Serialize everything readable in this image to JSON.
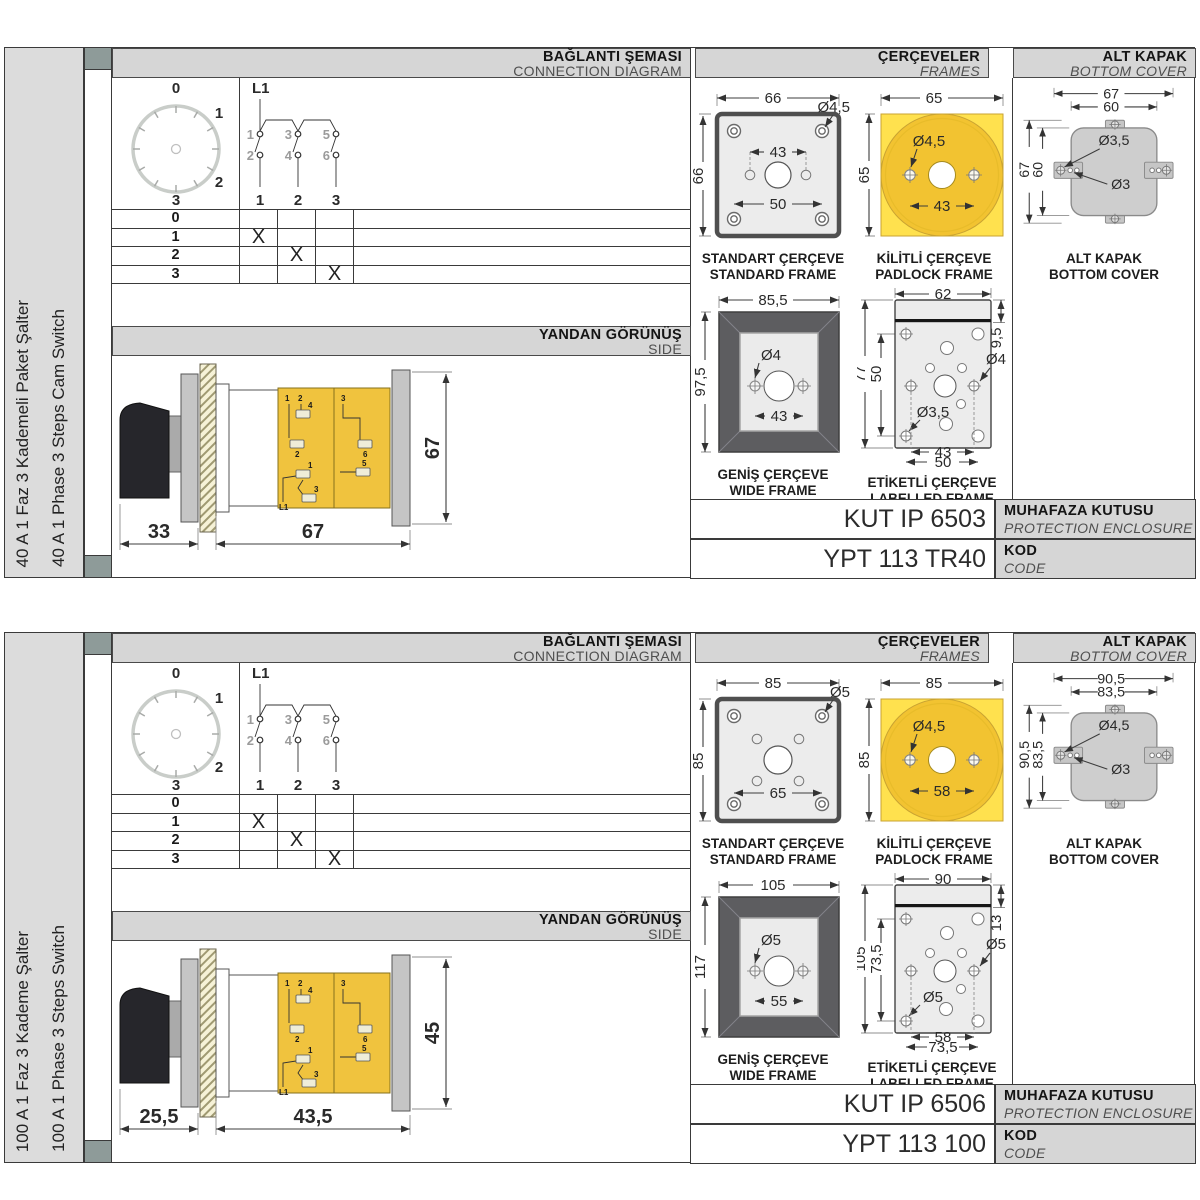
{
  "sections": [
    {
      "sidebar": {
        "title_tr": "40 A 1 Faz 3 Kademeli Paket Şalter",
        "title_en": "40 A 1 Phase 3 Steps Cam Switch"
      },
      "connection": {
        "header_tr": "BAĞLANTI ŞEMASI",
        "header_en": "CONNECTION DIAGRAM",
        "dial": {
          "p0": "0",
          "p1": "1",
          "p2": "2",
          "p3": "3"
        },
        "diagram": {
          "input": "L1",
          "t1": "1",
          "t2": "2",
          "t3": "3",
          "t4": "4",
          "t5": "5",
          "t6": "6",
          "o1": "1",
          "o2": "2",
          "o3": "3"
        },
        "table": {
          "rows": [
            {
              "label": "0",
              "c1": "",
              "c2": "",
              "c3": ""
            },
            {
              "label": "1",
              "c1": "X",
              "c2": "",
              "c3": ""
            },
            {
              "label": "2",
              "c1": "",
              "c2": "X",
              "c3": ""
            },
            {
              "label": "3",
              "c1": "",
              "c2": "",
              "c3": "X"
            }
          ]
        }
      },
      "side": {
        "header_tr": "YANDAN GÖRÜNÜŞ",
        "header_en": "SIDE",
        "dim_handle": "33",
        "dim_body": "67",
        "dim_height": "67",
        "t0": "1",
        "t1": "2",
        "t2": "4",
        "t3": "2",
        "t4": "3",
        "t5": "6",
        "t6": "1",
        "t7": "3",
        "t8": "5",
        "t9": "L1"
      },
      "frames": {
        "header_tr": "ÇERÇEVELER",
        "header_en": "FRAMES",
        "standard": {
          "dim_width": "66",
          "dim_height": "66",
          "dim_hole": "Ø4,5",
          "dim_inner": "43",
          "dim_outer": "50",
          "label_tr": "STANDART ÇERÇEVE",
          "label_en": "STANDARD FRAME"
        },
        "padlock": {
          "dim_width": "65",
          "dim_height": "65",
          "dim_hole": "Ø4,5",
          "dim_inner": "43",
          "label_tr": "KİLİTLİ ÇERÇEVE",
          "label_en": "PADLOCK FRAME"
        },
        "wide": {
          "dim_width": "85,5",
          "dim_height": "97,5",
          "dim_hole": "Ø4",
          "dim_inner": "43",
          "label_tr": "GENİŞ ÇERÇEVE",
          "label_en": "WIDE FRAME"
        },
        "labelled": {
          "dim_width": "62",
          "dim_strip": "9,5",
          "dim_height": "77",
          "dim_inner_h": "50",
          "dim_hole": "Ø4",
          "dim_hole_small": "Ø3,5",
          "dim_inner": "43",
          "dim_outer": "50",
          "label_tr": "ETİKETLİ ÇERÇEVE",
          "label_en": "LABELLED FRAME"
        }
      },
      "cover": {
        "header_tr": "ALT KAPAK",
        "header_en": "BOTTOM COVER",
        "dim_w1": "67",
        "dim_w2": "60",
        "dim_h1": "67",
        "dim_h2": "60",
        "dim_hole1": "Ø3,5",
        "dim_hole2": "Ø3",
        "label_tr": "ALT KAPAK",
        "label_en": "BOTTOM COVER"
      },
      "codes": {
        "enclosure_value": "KUT IP 6503",
        "enclosure_tr": "MUHAFAZA KUTUSU",
        "enclosure_en": "PROTECTION ENCLOSURE",
        "code_value": "YPT 113 TR40",
        "code_tr": "KOD",
        "code_en": "CODE"
      }
    },
    {
      "sidebar": {
        "title_tr": "100 A 1 Faz 3 Kademe Şalter",
        "title_en": "100 A 1 Phase 3 Steps Switch"
      },
      "connection": {
        "header_tr": "BAĞLANTI ŞEMASI",
        "header_en": "CONNECTION DIAGRAM",
        "dial": {
          "p0": "0",
          "p1": "1",
          "p2": "2",
          "p3": "3"
        },
        "diagram": {
          "input": "L1",
          "t1": "1",
          "t2": "2",
          "t3": "3",
          "t4": "4",
          "t5": "5",
          "t6": "6",
          "o1": "1",
          "o2": "2",
          "o3": "3"
        },
        "table": {
          "rows": [
            {
              "label": "0",
              "c1": "",
              "c2": "",
              "c3": ""
            },
            {
              "label": "1",
              "c1": "X",
              "c2": "",
              "c3": ""
            },
            {
              "label": "2",
              "c1": "",
              "c2": "X",
              "c3": ""
            },
            {
              "label": "3",
              "c1": "",
              "c2": "",
              "c3": "X"
            }
          ]
        }
      },
      "side": {
        "header_tr": "YANDAN GÖRÜNÜŞ",
        "header_en": "SIDE",
        "dim_handle": "25,5",
        "dim_body": "43,5",
        "dim_height": "45",
        "t0": "1",
        "t1": "2",
        "t2": "4",
        "t3": "2",
        "t4": "3",
        "t5": "6",
        "t6": "1",
        "t7": "3",
        "t8": "5",
        "t9": "L1"
      },
      "frames": {
        "header_tr": "ÇERÇEVELER",
        "header_en": "FRAMES",
        "standard": {
          "dim_width": "85",
          "dim_height": "85",
          "dim_hole": "Ø5",
          "dim_inner": "65",
          "label_tr": "STANDART ÇERÇEVE",
          "label_en": "STANDARD FRAME"
        },
        "padlock": {
          "dim_width": "85",
          "dim_height": "85",
          "dim_hole": "Ø4,5",
          "dim_inner": "58",
          "label_tr": "KİLİTLİ ÇERÇEVE",
          "label_en": "PADLOCK FRAME"
        },
        "wide": {
          "dim_width": "105",
          "dim_height": "117",
          "dim_hole": "Ø5",
          "dim_inner": "55",
          "label_tr": "GENİŞ ÇERÇEVE",
          "label_en": "WIDE FRAME"
        },
        "labelled": {
          "dim_width": "90",
          "dim_strip": "13",
          "dim_height": "105",
          "dim_inner_h": "73,5",
          "dim_hole": "Ø5",
          "dim_hole_small": "Ø5",
          "dim_inner": "58",
          "dim_outer": "73,5",
          "label_tr": "ETİKETLİ ÇERÇEVE",
          "label_en": "LABELLED FRAME"
        }
      },
      "cover": {
        "header_tr": "ALT KAPAK",
        "header_en": "BOTTOM COVER",
        "dim_w1": "90,5",
        "dim_w2": "83,5",
        "dim_h1": "90,5",
        "dim_h2": "83,5",
        "dim_hole1": "Ø4,5",
        "dim_hole2": "Ø3",
        "label_tr": "ALT KAPAK",
        "label_en": "BOTTOM COVER"
      },
      "codes": {
        "enclosure_value": "KUT IP 6506",
        "enclosure_tr": "MUHAFAZA KUTUSU",
        "enclosure_en": "PROTECTION ENCLOSURE",
        "code_value": "YPT 113 100",
        "code_tr": "KOD",
        "code_en": "CODE"
      }
    }
  ]
}
